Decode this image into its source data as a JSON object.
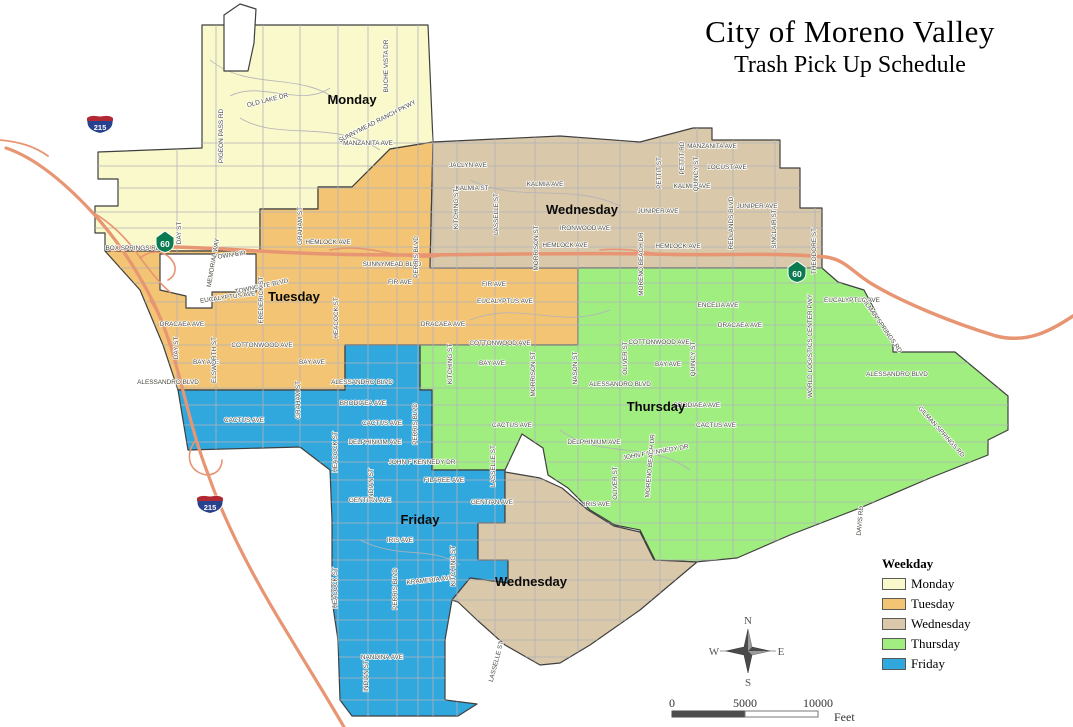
{
  "title": {
    "line1": "City of Moreno Valley",
    "line2": "Trash Pick Up Schedule"
  },
  "legend": {
    "heading": "Weekday",
    "items": [
      {
        "label": "Monday",
        "color": "#FAF9CB"
      },
      {
        "label": "Tuesday",
        "color": "#F3C473"
      },
      {
        "label": "Wednesday",
        "color": "#D9C8A9"
      },
      {
        "label": "Thursday",
        "color": "#A0EE80"
      },
      {
        "label": "Friday",
        "color": "#31A8DD"
      }
    ]
  },
  "map": {
    "zone_labels": [
      {
        "t": "Monday",
        "x": 352,
        "y": 104
      },
      {
        "t": "Tuesday",
        "x": 294,
        "y": 301
      },
      {
        "t": "Wednesday",
        "x": 582,
        "y": 214
      },
      {
        "t": "Thursday",
        "x": 656,
        "y": 411
      },
      {
        "t": "Friday",
        "x": 420,
        "y": 524
      },
      {
        "t": "Wednesday",
        "x": 531,
        "y": 586
      }
    ],
    "street_labels": [
      {
        "t": "MANZANITA AVE",
        "x": 368,
        "y": 145,
        "r": 0
      },
      {
        "t": "MANZANITA AVE",
        "x": 712,
        "y": 148,
        "r": 0
      },
      {
        "t": "JACLYN AVE",
        "x": 468,
        "y": 167,
        "r": 0
      },
      {
        "t": "LOCUST AVE",
        "x": 727,
        "y": 169,
        "r": 0
      },
      {
        "t": "KALMIA ST",
        "x": 472,
        "y": 190,
        "r": 0
      },
      {
        "t": "KALMIA AVE",
        "x": 545,
        "y": 186,
        "r": 0
      },
      {
        "t": "KALMIA AVE",
        "x": 692,
        "y": 188,
        "r": 0
      },
      {
        "t": "JUNIPER AVE",
        "x": 658,
        "y": 213,
        "r": 0
      },
      {
        "t": "JUNIPER AVE",
        "x": 757,
        "y": 208,
        "r": 0
      },
      {
        "t": "IRONWOOD AVE",
        "x": 585,
        "y": 230,
        "r": 0
      },
      {
        "t": "HEMLOCK AVE",
        "x": 328,
        "y": 244,
        "r": 0
      },
      {
        "t": "HEMLOCK AVE",
        "x": 565,
        "y": 247,
        "r": 0
      },
      {
        "t": "HEMLOCK AVE",
        "x": 678,
        "y": 248,
        "r": 0
      },
      {
        "t": "SUNNYMEAD BLVD",
        "x": 392,
        "y": 266,
        "r": 0
      },
      {
        "t": "TOWN CIR",
        "x": 230,
        "y": 257,
        "r": -8
      },
      {
        "t": "FIR AVE",
        "x": 400,
        "y": 284,
        "r": 0
      },
      {
        "t": "FIR AVE",
        "x": 494,
        "y": 286,
        "r": 0
      },
      {
        "t": "EUCALYPTUS AVE",
        "x": 228,
        "y": 299,
        "r": -8
      },
      {
        "t": "EUCALYPTUS AVE",
        "x": 505,
        "y": 303,
        "r": 0
      },
      {
        "t": "EUCALYPTUS AVE",
        "x": 852,
        "y": 302,
        "r": 0
      },
      {
        "t": "ENCELIA AVE",
        "x": 718,
        "y": 307,
        "r": 0
      },
      {
        "t": "DRACAEA AVE",
        "x": 182,
        "y": 326,
        "r": 0
      },
      {
        "t": "DRACAEA AVE",
        "x": 443,
        "y": 326,
        "r": 0
      },
      {
        "t": "DRACAEA AVE",
        "x": 740,
        "y": 327,
        "r": 0
      },
      {
        "t": "COTTONWOOD AVE",
        "x": 262,
        "y": 347,
        "r": 0
      },
      {
        "t": "COTTONWOOD AVE",
        "x": 500,
        "y": 345,
        "r": 0
      },
      {
        "t": "COTTONWOOD AVE",
        "x": 659,
        "y": 344,
        "r": 0
      },
      {
        "t": "BAY AVE",
        "x": 206,
        "y": 364,
        "r": 0
      },
      {
        "t": "BAY AVE",
        "x": 312,
        "y": 364,
        "r": 0
      },
      {
        "t": "BAY AVE",
        "x": 492,
        "y": 365,
        "r": 0
      },
      {
        "t": "BAY AVE",
        "x": 668,
        "y": 366,
        "r": 0
      },
      {
        "t": "ALESSANDRO BLVD",
        "x": 168,
        "y": 384,
        "r": 0
      },
      {
        "t": "ALESSANDRO BLVD",
        "x": 362,
        "y": 384,
        "r": 0
      },
      {
        "t": "ALESSANDRO BLVD",
        "x": 620,
        "y": 386,
        "r": 0
      },
      {
        "t": "ALESSANDRO BLVD",
        "x": 897,
        "y": 376,
        "r": 0
      },
      {
        "t": "BRODIAEA AVE",
        "x": 363,
        "y": 405,
        "r": 0
      },
      {
        "t": "BRODIAEA AVE",
        "x": 697,
        "y": 407,
        "r": 0
      },
      {
        "t": "CACTUS AVE",
        "x": 244,
        "y": 422,
        "r": 0
      },
      {
        "t": "CACTUS AVE",
        "x": 382,
        "y": 425,
        "r": 0
      },
      {
        "t": "CACTUS AVE",
        "x": 512,
        "y": 427,
        "r": 0
      },
      {
        "t": "CACTUS AVE",
        "x": 716,
        "y": 427,
        "r": 0
      },
      {
        "t": "DELPHINIUM AVE",
        "x": 375,
        "y": 444,
        "r": 0
      },
      {
        "t": "DELPHINIUM AVE",
        "x": 594,
        "y": 444,
        "r": 0
      },
      {
        "t": "JOHN F KENNEDY DR",
        "x": 422,
        "y": 464,
        "r": 0
      },
      {
        "t": "JOHN F KENNEDY DR",
        "x": 656,
        "y": 454,
        "r": -10
      },
      {
        "t": "FILAREE AVE",
        "x": 444,
        "y": 482,
        "r": 0
      },
      {
        "t": "GENTIAN AVE",
        "x": 370,
        "y": 502,
        "r": 0
      },
      {
        "t": "GENTIAN AVE",
        "x": 492,
        "y": 504,
        "r": 0
      },
      {
        "t": "IRIS AVE",
        "x": 400,
        "y": 542,
        "r": 0
      },
      {
        "t": "IRIS AVE",
        "x": 597,
        "y": 506,
        "r": 0
      },
      {
        "t": "KRAMERIA AVE",
        "x": 430,
        "y": 582,
        "r": -6
      },
      {
        "t": "NANDINA AVE",
        "x": 382,
        "y": 659,
        "r": 0
      },
      {
        "t": "BOX SPRINGS RD",
        "x": 133,
        "y": 250,
        "r": 0
      },
      {
        "t": "OLD LAKE DR",
        "x": 268,
        "y": 102,
        "r": -14
      },
      {
        "t": "SUNNYMEAD RANCH PKWY",
        "x": 378,
        "y": 123,
        "r": -27
      },
      {
        "t": "TOWNGATE BLVD",
        "x": 262,
        "y": 288,
        "r": -12
      },
      {
        "t": "BUCHE VISTA DR",
        "x": 388,
        "y": 66,
        "r": -90
      },
      {
        "t": "PIGEON PASS RD",
        "x": 223,
        "y": 136,
        "r": -90
      },
      {
        "t": "DAY ST",
        "x": 181,
        "y": 233,
        "r": -90
      },
      {
        "t": "DAY ST",
        "x": 178,
        "y": 348,
        "r": -90
      },
      {
        "t": "MEMORIAL WAY",
        "x": 215,
        "y": 263,
        "r": -80
      },
      {
        "t": "GRAHAM ST",
        "x": 302,
        "y": 226,
        "r": -90
      },
      {
        "t": "GRAHAM ST",
        "x": 300,
        "y": 400,
        "r": -90
      },
      {
        "t": "ELSWORTH ST",
        "x": 216,
        "y": 360,
        "r": -90
      },
      {
        "t": "FREDERICK ST",
        "x": 263,
        "y": 300,
        "r": -90
      },
      {
        "t": "HEACOCK ST",
        "x": 338,
        "y": 318,
        "r": -90
      },
      {
        "t": "HEACOCK ST",
        "x": 337,
        "y": 452,
        "r": -90
      },
      {
        "t": "HEACOCK ST",
        "x": 337,
        "y": 588,
        "r": -90
      },
      {
        "t": "INDIAN ST",
        "x": 373,
        "y": 484,
        "r": -90
      },
      {
        "t": "INDIAN ST",
        "x": 368,
        "y": 676,
        "r": -90
      },
      {
        "t": "PERRIS BLVD",
        "x": 418,
        "y": 257,
        "r": -90
      },
      {
        "t": "PERRIS BLVD",
        "x": 417,
        "y": 424,
        "r": -90
      },
      {
        "t": "PERRIS BLVD",
        "x": 397,
        "y": 589,
        "r": -90
      },
      {
        "t": "KITCHING ST",
        "x": 458,
        "y": 209,
        "r": -90
      },
      {
        "t": "KITCHING ST",
        "x": 452,
        "y": 364,
        "r": -90
      },
      {
        "t": "KITCHING ST",
        "x": 455,
        "y": 566,
        "r": -90
      },
      {
        "t": "LASSELLE ST",
        "x": 498,
        "y": 214,
        "r": -90
      },
      {
        "t": "LASSELLE ST",
        "x": 495,
        "y": 466,
        "r": -90
      },
      {
        "t": "LASSELLE ST",
        "x": 498,
        "y": 662,
        "r": -75
      },
      {
        "t": "MORRISON ST",
        "x": 538,
        "y": 248,
        "r": -90
      },
      {
        "t": "MORRISON ST",
        "x": 535,
        "y": 374,
        "r": -90
      },
      {
        "t": "NASON ST",
        "x": 577,
        "y": 368,
        "r": -90
      },
      {
        "t": "OLIVER ST",
        "x": 627,
        "y": 358,
        "r": -90
      },
      {
        "t": "OLIVER ST",
        "x": 617,
        "y": 483,
        "r": -90
      },
      {
        "t": "QUINCY ST",
        "x": 698,
        "y": 174,
        "r": -90
      },
      {
        "t": "QUINCY ST",
        "x": 695,
        "y": 359,
        "r": -90
      },
      {
        "t": "PETTIT ST",
        "x": 661,
        "y": 173,
        "r": -90
      },
      {
        "t": "PETTIT RD",
        "x": 684,
        "y": 158,
        "r": -90
      },
      {
        "t": "MORENO BEACH DR",
        "x": 643,
        "y": 264,
        "r": -90
      },
      {
        "t": "MORENO BEACH DR",
        "x": 652,
        "y": 466,
        "r": -85
      },
      {
        "t": "REDLANDS BLVD",
        "x": 733,
        "y": 223,
        "r": -90
      },
      {
        "t": "SINCLAIR ST",
        "x": 776,
        "y": 229,
        "r": -90
      },
      {
        "t": "THEODORE ST",
        "x": 816,
        "y": 251,
        "r": -90
      },
      {
        "t": "WORLD LOGISTICS CENTER PWY",
        "x": 812,
        "y": 346,
        "r": -90
      },
      {
        "t": "GILMAN SPRINGS RD",
        "x": 880,
        "y": 326,
        "r": 55
      },
      {
        "t": "GILMAN SPRINGS RD",
        "x": 940,
        "y": 433,
        "r": 48
      },
      {
        "t": "DAVIS RD",
        "x": 862,
        "y": 521,
        "r": -85
      }
    ],
    "shields": [
      {
        "type": "interstate",
        "text": "215",
        "x": 100,
        "y": 123
      },
      {
        "type": "interstate",
        "text": "215",
        "x": 210,
        "y": 503
      },
      {
        "type": "state",
        "text": "60",
        "x": 165,
        "y": 241
      },
      {
        "type": "state",
        "text": "60",
        "x": 797,
        "y": 271
      }
    ],
    "zone_colors": {
      "monday": "#FAF9CB",
      "tuesday": "#F3C473",
      "wednesday": "#D9C8A9",
      "thursday": "#A0EE80",
      "friday": "#31A8DD",
      "freeway": "#E79572"
    }
  },
  "compass": {
    "n": "N",
    "s": "S",
    "e": "E",
    "w": "W"
  },
  "scale_bar": {
    "ticks": [
      "0",
      "5000",
      "10000"
    ],
    "unit": "Feet"
  }
}
